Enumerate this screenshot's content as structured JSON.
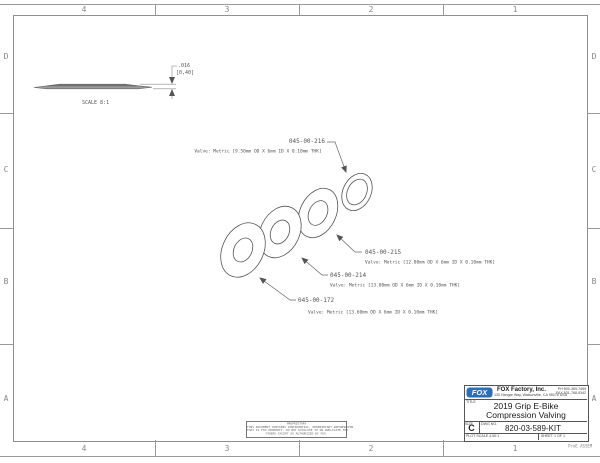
{
  "zones": {
    "cols": [
      "4",
      "3",
      "2",
      "1"
    ],
    "rows": [
      "D",
      "C",
      "B",
      "A"
    ]
  },
  "side_view": {
    "dim_inch": ".016",
    "dim_mm": "[0,40]",
    "scale_label": "SCALE  8:1"
  },
  "callouts": [
    {
      "part": "045-00-216",
      "spec": "Valve: Metric [9.50mm OD X 6mm ID X 0.10mm THK]"
    },
    {
      "part": "045-00-215",
      "spec": "Valve: Metric [12.00mm OD X 6mm ID X 0.10mm THK]"
    },
    {
      "part": "045-00-214",
      "spec": "Valve: Metric [13.00mm OD X 6mm ID X 0.10mm THK]"
    },
    {
      "part": "045-00-172",
      "spec": "Valve: Metric [13.60mm OD X 6mm ID X 0.10mm THK]"
    }
  ],
  "proprietary": {
    "heading": "PROPRIETARY",
    "line1": "THIS DOCUMENT CONTAINS CONFIDENTIAL, PROPRIETARY INFORMATION",
    "line2": "THAT IS FOX PROPERTY. DO NOT DISCLOSE TO OR DUPLICATE FOR",
    "line3": "OTHERS EXCEPT AS AUTHORIZED BY FOX."
  },
  "title_block": {
    "logo_text": "FOX",
    "logo_color": "#2a6fbd",
    "company": "FOX Factory, Inc.",
    "address": "130 Hangar Way, Watsonville, CA 95076 USA",
    "phone": "PH 800-369-7469",
    "fax": "FAX 831-768-9342",
    "title_label": "TITLE",
    "title_line1": "2019 Grip E-Bike",
    "title_line2": "Compression Valving",
    "size_label": "SIZE",
    "size": "C",
    "dwg_label": "DWG NO.",
    "dwg_no": "820-03-589-KIT",
    "plot_scale": "PLOT SCALE 4.00:1",
    "sheet": "SHEET 1 OF 1",
    "footer_note": "ProE ASSEM"
  }
}
